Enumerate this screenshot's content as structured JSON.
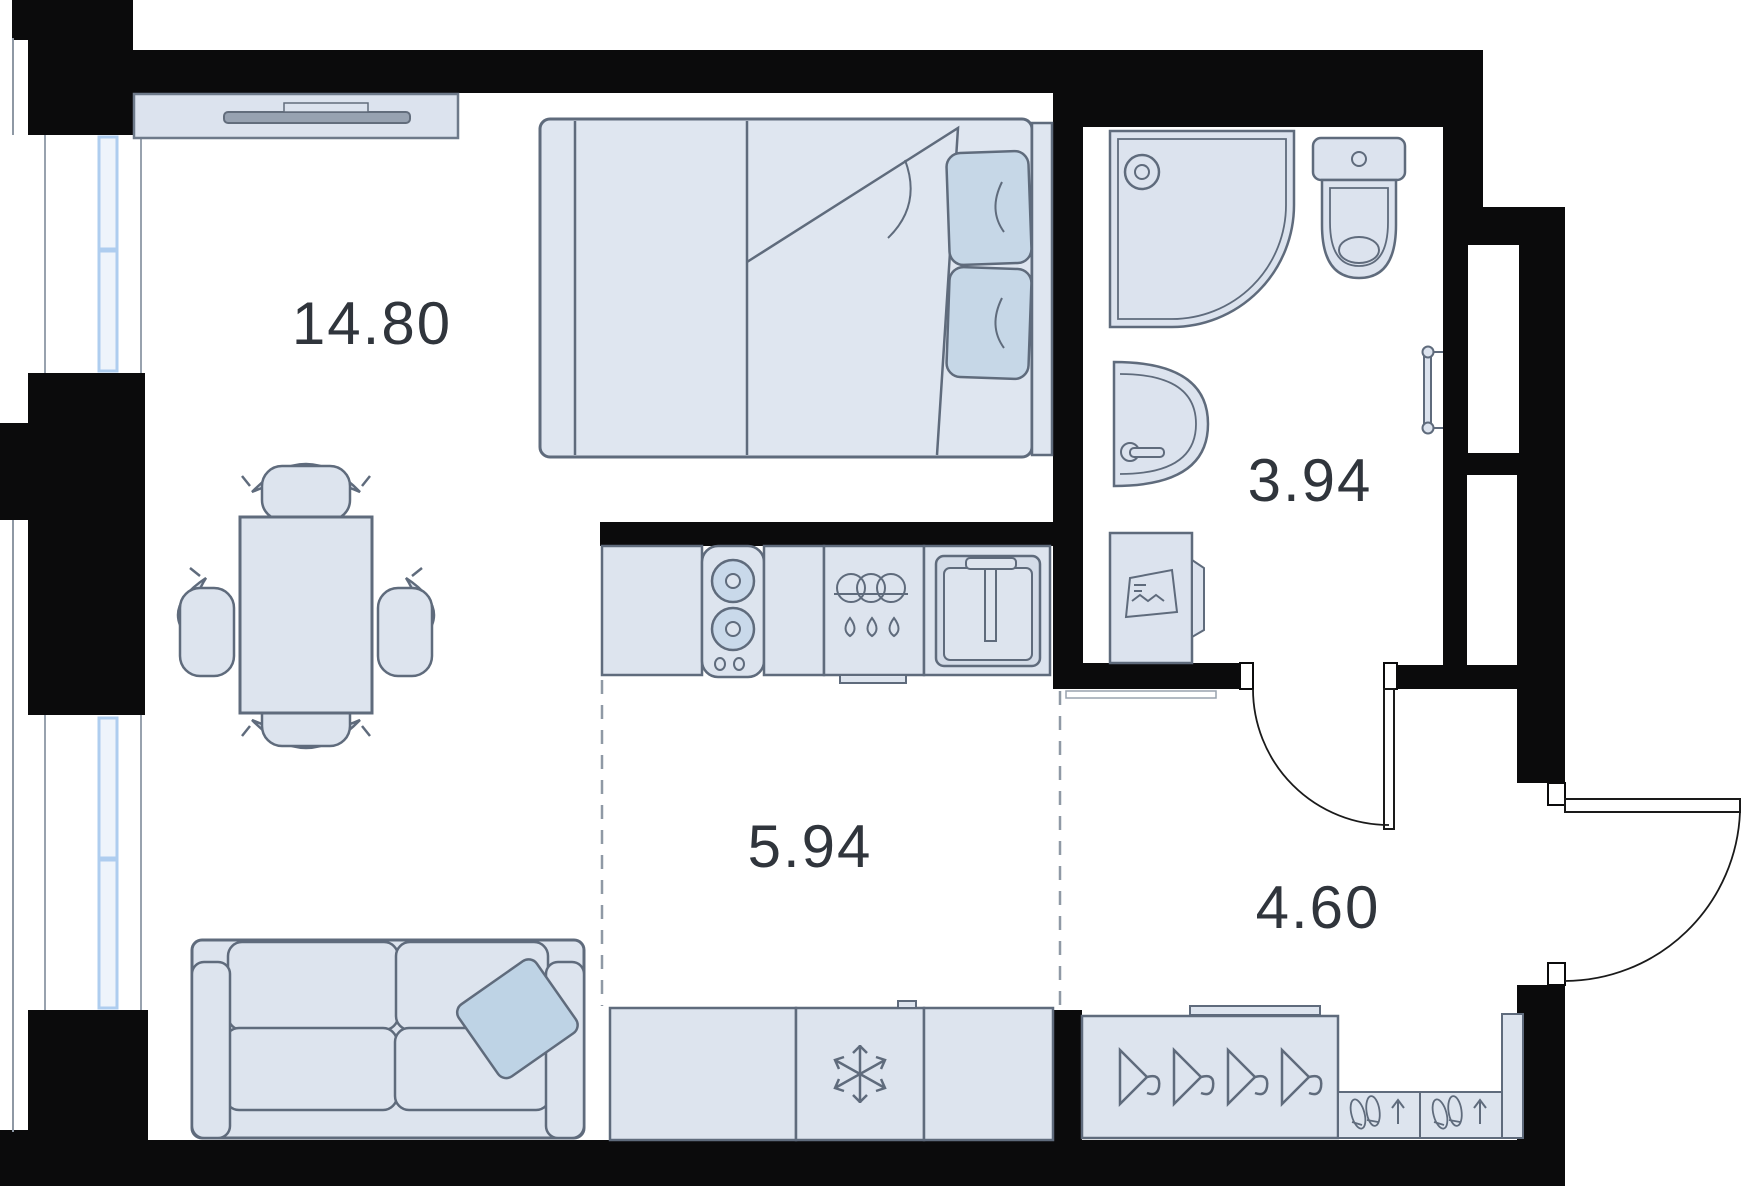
{
  "floor_plan": {
    "rooms": [
      {
        "name": "living-room",
        "area": "14.80"
      },
      {
        "name": "bathroom",
        "area": "3.94"
      },
      {
        "name": "kitchen",
        "area": "5.94"
      },
      {
        "name": "hallway",
        "area": "4.60"
      }
    ],
    "colors": {
      "wall": "#0b0b0c",
      "furniture_fill": "#dde4ee",
      "furniture_stroke": "#5f6b7c",
      "textile_accent": "#c6d7e7",
      "window_glass_stroke": "#aecdef",
      "label_text": "#30353c",
      "floor": "#ffffff",
      "zone_dash": "#8f99a5"
    },
    "furniture": [
      "tv-unit",
      "double-bed",
      "dining-table",
      "chair",
      "sofa",
      "stove",
      "dishwasher",
      "kitchen-sink",
      "fridge",
      "washing-machine",
      "shower",
      "toilet",
      "bathroom-sink",
      "towel-rail",
      "wardrobe",
      "shoe-rack"
    ]
  }
}
